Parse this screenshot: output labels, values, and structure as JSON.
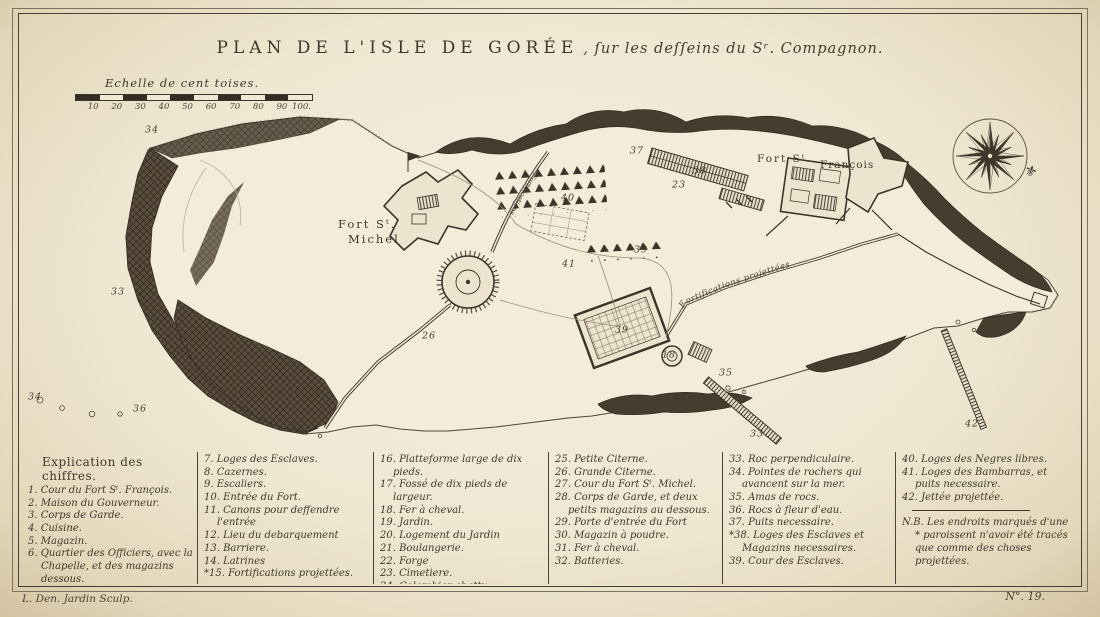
{
  "plate": {
    "title_main": "PLAN DE L'ISLE DE GORÉE",
    "title_sub": ", ſur les deſſeins du Sʳ. Compagnon.",
    "engraver_credit": "L. Den. Jardin Sculp.",
    "plate_number": "N°. 19.",
    "ink_color": "#3e372b",
    "paper_color": "#efe7d2"
  },
  "scale": {
    "label": "Echelle de cent toises.",
    "ticks": [
      "10",
      "20",
      "30",
      "40",
      "50",
      "60",
      "70",
      "80",
      "90",
      "100."
    ]
  },
  "map": {
    "labels": {
      "fort_michel_line1": "Fort Sᵗ.",
      "fort_michel_line2": "Michel",
      "fort_francois_line1": "Fort Sᵗ.",
      "fort_francois_line2": "François",
      "wall_label": "Fortifications projettées",
      "wall_label_west": "Fortifications"
    },
    "compass_icon": "compass-rose-16-point",
    "compass_pointer_icon": "fleur-de-lis",
    "annotations": [
      {
        "n": "34",
        "x": 152,
        "y": 130
      },
      {
        "n": "33",
        "x": 118,
        "y": 292
      },
      {
        "n": "34",
        "x": 35,
        "y": 397
      },
      {
        "n": "36",
        "x": 140,
        "y": 409
      },
      {
        "n": "36",
        "x": 298,
        "y": 428
      },
      {
        "n": "37",
        "x": 637,
        "y": 151
      },
      {
        "n": "38",
        "x": 700,
        "y": 171
      },
      {
        "n": "23",
        "x": 679,
        "y": 185
      },
      {
        "n": "40",
        "x": 568,
        "y": 198
      },
      {
        "n": "26",
        "x": 429,
        "y": 336
      },
      {
        "n": "39",
        "x": 641,
        "y": 250
      },
      {
        "n": "41",
        "x": 569,
        "y": 264
      },
      {
        "n": "39",
        "x": 622,
        "y": 330
      },
      {
        "n": "18",
        "x": 669,
        "y": 355
      },
      {
        "n": "35",
        "x": 726,
        "y": 373
      },
      {
        "n": "33",
        "x": 757,
        "y": 434
      },
      {
        "n": "42",
        "x": 972,
        "y": 424
      }
    ]
  },
  "legend": {
    "heading": "Explication des chiffres.",
    "col1": [
      "1. Cour du Fort Sᵗ. François.",
      "2. Maison du Gouverneur.",
      "3. Corps de Garde.",
      "4. Cuisine.",
      "5. Magazin.",
      "6. Quartier des Officiers, avec la Chapelle, et des magazins dessous."
    ],
    "col2": [
      "7. Loges des Esclaves.",
      "8. Cazernes.",
      "9. Escaliers.",
      "10. Entrée du Fort.",
      "11. Canons pour deffendre l'entrée",
      "12. Lieu du debarquement",
      "13. Barriere.",
      "14. Latrines",
      "*15. Fortifications projettées."
    ],
    "col3": [
      "16. Platteforme large de dix pieds.",
      "17. Fossé de dix pieds de largeur.",
      "18. Fer à cheval.",
      "19. Jardin.",
      "20. Logement du Jardin",
      "21. Boulangerie.",
      "22. Forge",
      "23. Cimetiere.",
      "24. Colombier abattu."
    ],
    "col4": [
      "25. Petite Citerne.",
      "26. Grande Citerne.",
      "27. Cour du Fort Sᵗ. Michel.",
      "28. Corps de Garde, et deux petits magazins au dessous.",
      "29. Porte d'entrée du Fort",
      "30. Magazin à poudre.",
      "31. Fer à cheval.",
      "32. Batteries."
    ],
    "col5": [
      "33. Roc perpendiculaire.",
      "34. Pointes de rochers qui avancent sur la mer.",
      "35. Amas de rocs.",
      "36. Rocs à fleur d'eau.",
      "37. Puits necessaire.",
      "*38. Loges des Esclaves et Magazins necessaires.",
      "39. Cour des Esclaves."
    ],
    "col6": [
      "40. Loges des Negres libres.",
      "41. Loges des Bambarras, et puits necessaire.",
      "42. Jettée projettée."
    ],
    "note": "N.B. Les endroits marqués d'une * paroissent n'avoir été tracés que comme des choses projettées."
  }
}
